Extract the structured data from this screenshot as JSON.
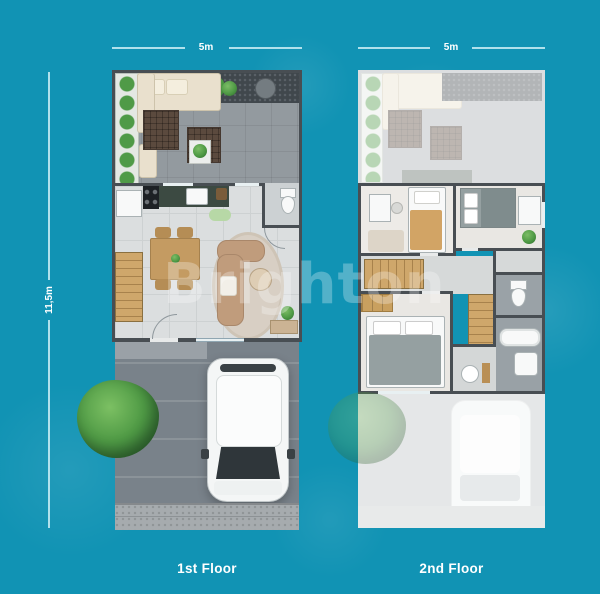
{
  "watermark": {
    "text": "Brighton",
    "color": "#ffffff"
  },
  "dimensions": {
    "first_floor_width": "5m",
    "second_floor_width": "5m",
    "plot_depth": "11,5m"
  },
  "floors": {
    "first": {
      "label": "1st Floor"
    },
    "second": {
      "label": "2nd Floor"
    }
  },
  "colors": {
    "background": "#1193b4",
    "dimension_line": "#cdeef6",
    "dimension_text": "#ffffff",
    "floor_label_text": "#ffffff",
    "watermark": "#ffffff",
    "wall": "#484e53",
    "terrace_floor": "#939a9f",
    "pebble_bed": "#40474c",
    "foliage": "#56a04d",
    "interior_floor": "#dbdedf",
    "carport_floor": "#79828a",
    "gravel": "#a6abae",
    "wood_stairs": "#c9a368",
    "sofa_tan": "#c09c7c",
    "sofa_cream": "#e9e0cd",
    "rug": "#d8cfc4",
    "kitchen_counter": "#3c4a42",
    "appliance": "#1d2125",
    "fixture_white": "#f8f9f9",
    "bed_blanket_tan": "#d2a465",
    "bed_gray": "#95a0a1"
  }
}
